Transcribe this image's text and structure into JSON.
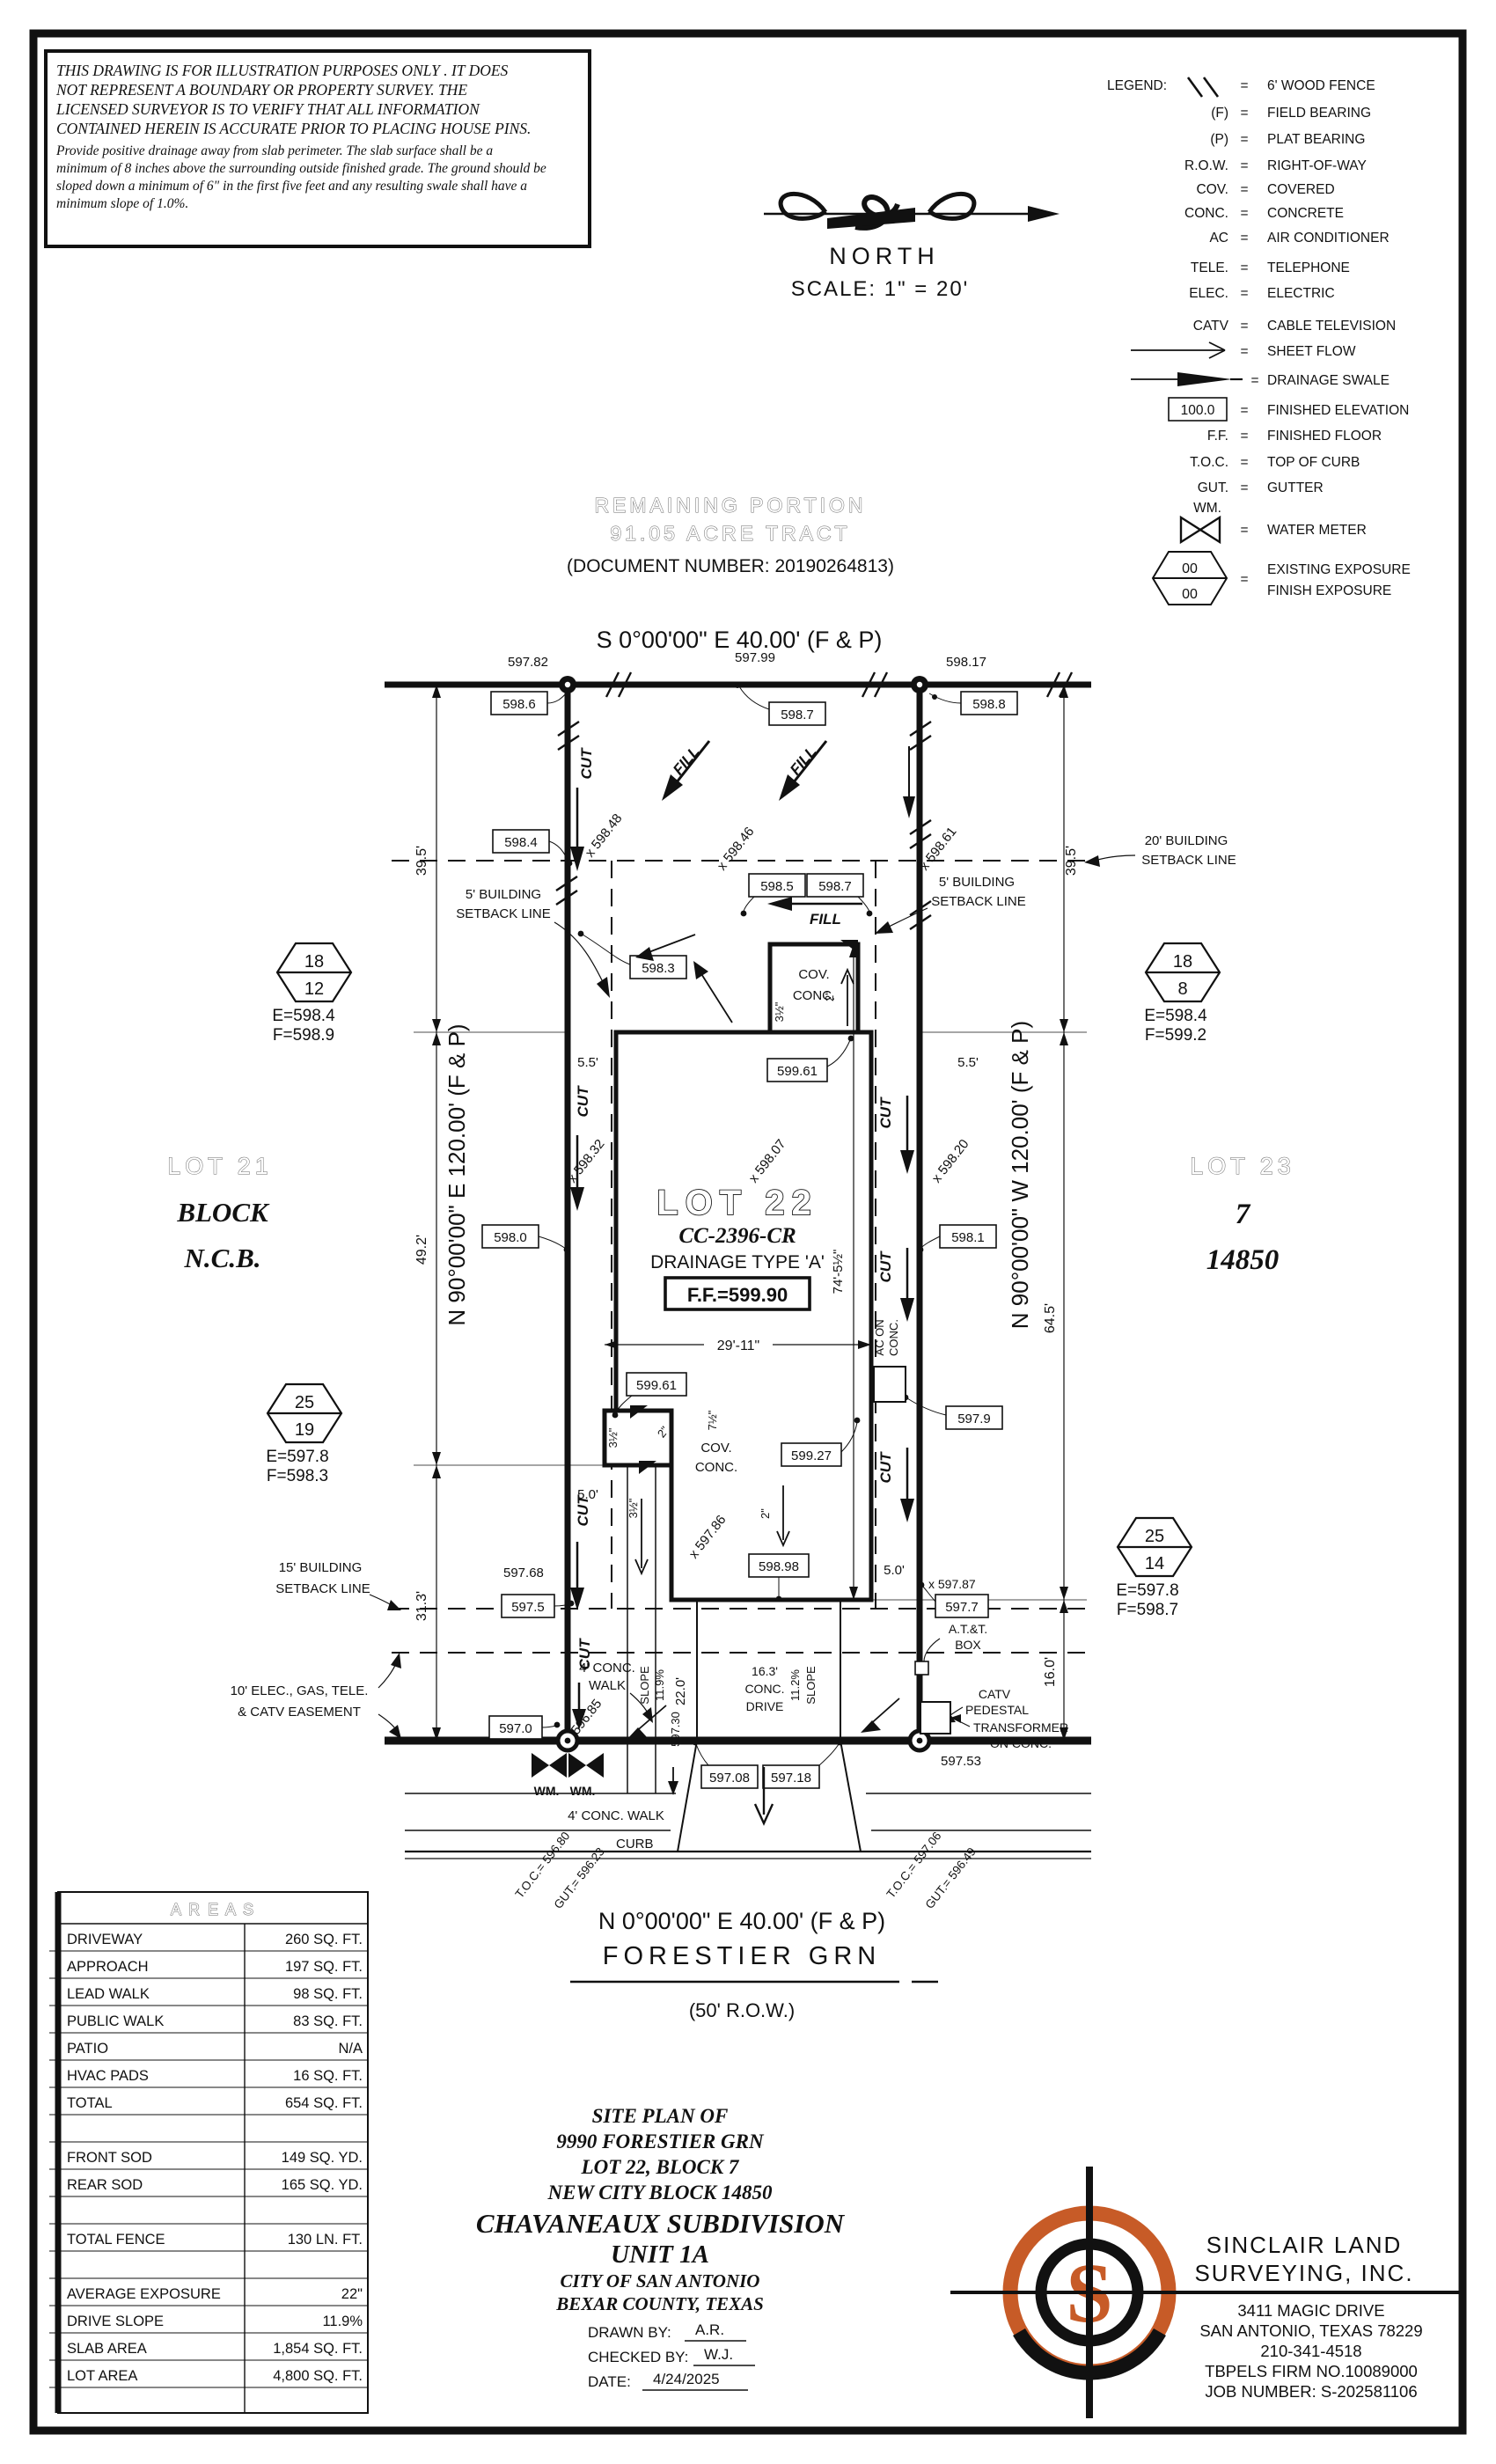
{
  "sheet": {
    "disclaimer": {
      "line1": "THIS DRAWING IS FOR ILLUSTRATION PURPOSES ONLY . IT DOES",
      "line2": "NOT REPRESENT A BOUNDARY OR PROPERTY SURVEY. THE",
      "line3": "LICENSED SURVEYOR IS TO VERIFY THAT ALL INFORMATION",
      "line4": "CONTAINED HEREIN IS ACCURATE PRIOR TO PLACING HOUSE PINS.",
      "line5": "Provide positive drainage away from slab perimeter. The slab surface shall be a",
      "line6": "minimum of 8 inches above the surrounding outside finished grade. The ground should be",
      "line7": "sloped down a minimum of 6\" in the first five feet and any resulting swale shall have a",
      "line8": "minimum slope of 1.0%."
    },
    "legend": {
      "title": "LEGEND:",
      "eq": "=",
      "items": [
        {
          "sym": "",
          "desc": "6' WOOD FENCE"
        },
        {
          "sym": "(F)",
          "desc": "FIELD BEARING"
        },
        {
          "sym": "(P)",
          "desc": "PLAT BEARING"
        },
        {
          "sym": "R.O.W.",
          "desc": "RIGHT-OF-WAY"
        },
        {
          "sym": "COV.",
          "desc": "COVERED"
        },
        {
          "sym": "CONC.",
          "desc": "CONCRETE"
        },
        {
          "sym": "AC",
          "desc": "AIR CONDITIONER"
        },
        {
          "sym": "TELE.",
          "desc": "TELEPHONE"
        },
        {
          "sym": "ELEC.",
          "desc": "ELECTRIC"
        },
        {
          "sym": "CATV",
          "desc": "CABLE TELEVISION"
        },
        {
          "sym": "",
          "desc": "SHEET FLOW"
        },
        {
          "sym": "",
          "desc": "DRAINAGE SWALE"
        },
        {
          "sym": "100.0",
          "desc": "FINISHED ELEVATION"
        },
        {
          "sym": "F.F.",
          "desc": "FINISHED FLOOR"
        },
        {
          "sym": "T.O.C.",
          "desc": "TOP OF CURB"
        },
        {
          "sym": "GUT.",
          "desc": "GUTTER"
        },
        {
          "sym": "WM.",
          "desc": "WATER METER"
        },
        {
          "sym": "00",
          "sym2": "00",
          "desc": "EXISTING EXPOSURE",
          "desc2": "FINISH EXPOSURE"
        }
      ]
    },
    "north": {
      "label": "NORTH",
      "scale": "SCALE: 1\" = 20'"
    },
    "tract": {
      "line1": "REMAINING PORTION",
      "line2": "91.05 ACRE TRACT",
      "line3": "(DOCUMENT NUMBER: 20190264813)"
    }
  },
  "plan": {
    "bearing_top": "S 0°00'00\" E 40.00' (F & P)",
    "bearing_bottom": "N 0°00'00\" E 40.00' (F & P)",
    "bearing_left": "N 90°00'00\" E 120.00' (F & P)",
    "bearing_right": "N 90°00'00\" W 120.00' (F & P)",
    "street": "FORESTIER GRN",
    "row": "(50' R.O.W.)",
    "lot21": {
      "name": "LOT 21",
      "l2": "BLOCK",
      "l3": "N.C.B."
    },
    "lot23": {
      "name": "LOT 23",
      "l2": "7",
      "l3": "14850"
    },
    "lot22": {
      "name": "LOT 22",
      "cc": "CC-2396-CR",
      "drainage": "DRAINAGE TYPE 'A'",
      "ff": "F.F.=599.90"
    },
    "hex": {
      "a": {
        "top": "18",
        "bot": "12",
        "e": "E=598.4",
        "f": "F=598.9"
      },
      "b": {
        "top": "18",
        "bot": "8",
        "e": "E=598.4",
        "f": "F=599.2"
      },
      "c": {
        "top": "25",
        "bot": "19",
        "e": "E=597.8",
        "f": "F=598.3"
      },
      "d": {
        "top": "25",
        "bot": "14",
        "e": "E=597.8",
        "f": "F=598.7"
      }
    },
    "corners": {
      "nw": "597.82",
      "n": "597.99",
      "ne": "598.17",
      "se": "597.53"
    },
    "boxed": {
      "a": "598.6",
      "b": "598.7",
      "c": "598.8",
      "d": "598.4",
      "e": "598.3",
      "f": "598.5",
      "g": "598.7",
      "h": "599.61",
      "i": "598.0",
      "j": "598.1",
      "k": "599.61",
      "l": "599.27",
      "m": "597.9",
      "n": "598.98",
      "o": "597.5",
      "p": "597.7",
      "q": "597.0",
      "r": "597.08",
      "s": "597.18"
    },
    "spots": {
      "s1": "x 598.48",
      "s2": "x 598.46",
      "s3": "x 598.61",
      "s4": "x 598.32",
      "s5": "x 598.07",
      "s6": "x 598.20",
      "s7": "x 597.86",
      "s8": "596.85",
      "s9": "x 597.87",
      "s10": "597.68"
    },
    "cutfill": {
      "cut": "CUT",
      "fill": "FILL"
    },
    "dims": {
      "d395": "39.5'",
      "d492": "49.2'",
      "d313": "31.3'",
      "d645": "64.5'",
      "d160": "16.0'",
      "d55": "5.5'",
      "d50": "5.0'",
      "d2911": "29'-11\"",
      "d745": "74'-5½\"",
      "d220": "22.0'",
      "d163": "16.3'",
      "conc": "CONC.",
      "drive": "DRIVE",
      "slope": "SLOPE",
      "s119": "11.9%",
      "s112": "11.2%",
      "e59730": "597.30",
      "d35": "3½\"",
      "d2": "2\"",
      "d75": "7½\""
    },
    "notes": {
      "sb5a": "5' BUILDING",
      "sb5b": "SETBACK LINE",
      "sb20a": "20' BUILDING",
      "sb15a": "15' BUILDING",
      "ease1": "10' ELEC., GAS, TELE.",
      "ease2": "& CATV EASEMENT",
      "acon1": "AC ON",
      "acon2": "CONC.",
      "cov1": "COV.",
      "cov2": "CONC.",
      "walk1": "4' CONC.",
      "walk2": "WALK",
      "walk3": "4' CONC. WALK",
      "curb": "CURB",
      "att1": "A.T.&T.",
      "att2": "BOX",
      "catv1": "CATV",
      "catv2": "PEDESTAL",
      "xfmr1": "TRANSFORMER",
      "xfmr2": "ON CONC.",
      "wm": "WM.",
      "toc_l1": "T.O.C.= 596.80",
      "toc_l2": "GUT.= 596.23",
      "toc_r1": "T.O.C.= 597.06",
      "toc_r2": "GUT.= 596.49"
    }
  },
  "areas": {
    "title": "A R E A S",
    "rows": [
      {
        "label": "DRIVEWAY",
        "value": "260 SQ. FT."
      },
      {
        "label": "APPROACH",
        "value": "197 SQ. FT."
      },
      {
        "label": "LEAD WALK",
        "value": "98 SQ. FT."
      },
      {
        "label": "PUBLIC WALK",
        "value": "83 SQ. FT."
      },
      {
        "label": "PATIO",
        "value": "N/A"
      },
      {
        "label": "HVAC PADS",
        "value": "16 SQ. FT."
      },
      {
        "label": "TOTAL",
        "value": "654 SQ. FT."
      },
      {
        "label": "",
        "value": ""
      },
      {
        "label": "FRONT SOD",
        "value": "149 SQ. YD."
      },
      {
        "label": "REAR SOD",
        "value": "165 SQ. YD."
      },
      {
        "label": "",
        "value": ""
      },
      {
        "label": "TOTAL FENCE",
        "value": "130 LN. FT."
      },
      {
        "label": "",
        "value": ""
      },
      {
        "label": "AVERAGE EXPOSURE",
        "value": "22\""
      },
      {
        "label": "DRIVE SLOPE",
        "value": "11.9%"
      },
      {
        "label": "SLAB AREA",
        "value": "1,854 SQ. FT."
      },
      {
        "label": "LOT AREA",
        "value": "4,800 SQ. FT."
      },
      {
        "label": "",
        "value": ""
      }
    ]
  },
  "titleblock": {
    "l1": "SITE PLAN OF",
    "l2": "9990 FORESTIER GRN",
    "l3": "LOT 22, BLOCK 7",
    "l4": "NEW CITY BLOCK 14850",
    "l5": "CHAVANEAUX SUBDIVISION",
    "l6": "UNIT 1A",
    "l7": "CITY OF SAN ANTONIO",
    "l8": "BEXAR COUNTY, TEXAS",
    "drawn_label": "DRAWN BY:",
    "drawn": "A.R.",
    "checked_label": "CHECKED BY:",
    "checked": "W.J.",
    "date_label": "DATE:",
    "date": "4/24/2025"
  },
  "company": {
    "name1": "SINCLAIR LAND",
    "name2": "SURVEYING, INC.",
    "addr1": "3411 MAGIC DRIVE",
    "addr2": "SAN ANTONIO, TEXAS 78229",
    "phone": "210-341-4518",
    "firm": "TBPELS FIRM NO.10089000",
    "job": "JOB NUMBER: S-202581106",
    "logo_s": "S"
  },
  "colors": {
    "accent": "#C75B27",
    "ink": "#111111"
  }
}
